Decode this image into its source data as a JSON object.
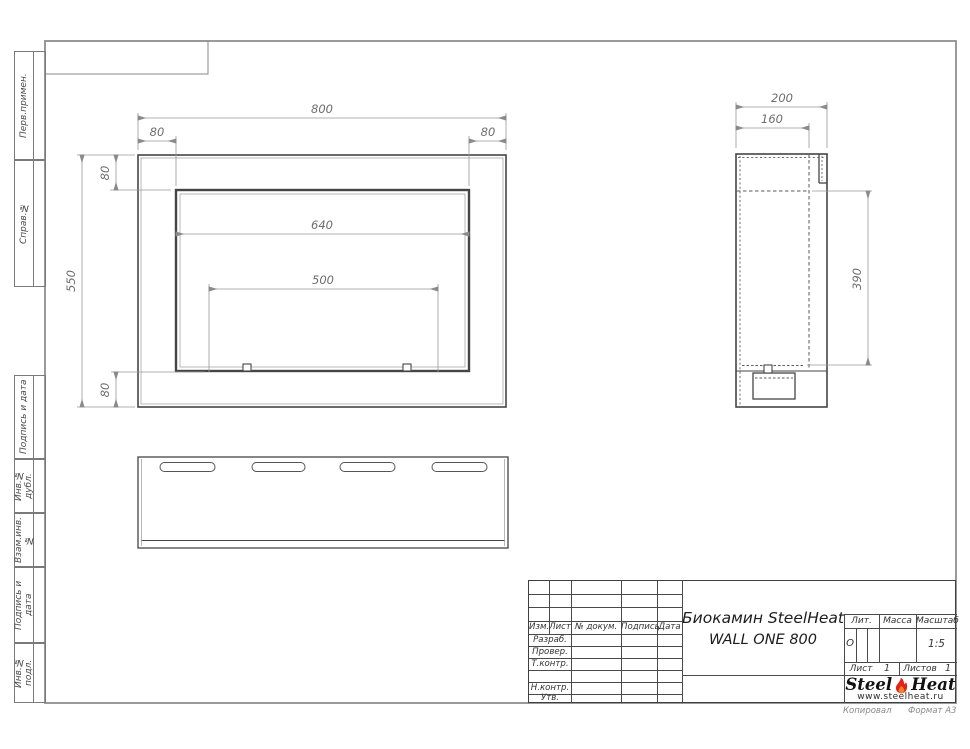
{
  "sidebar": {
    "top": [
      "Перв.примен.",
      "Справ.№"
    ],
    "bottom": [
      "Подпись и дата",
      "Инв.№ дубл.",
      "Взам.инв.№",
      "Подпись и дата",
      "Инв.№ подл."
    ]
  },
  "dims": {
    "front": {
      "total_width": "800",
      "flange_left": "80",
      "flange_right": "80",
      "flange_top": "80",
      "height": "550",
      "opening_width": "640",
      "burner_width": "500",
      "flange_bottom": "80"
    },
    "side": {
      "depth": "200",
      "inner_depth": "160",
      "inner_height": "390"
    }
  },
  "title_block": {
    "header_cols": [
      "Изм.",
      "Лист",
      "№ докум.",
      "Подпись",
      "Дата"
    ],
    "rows": [
      "Разраб.",
      "Провер.",
      "Т.контр.",
      "Н.контр.",
      "Утв."
    ],
    "title_line1": "Биокамин SteelHeat",
    "title_line2": "WALL ONE 800",
    "lit_label": "Лит.",
    "lit_value": "О",
    "massa_label": "Масса",
    "masshtab_label": "Масштаб",
    "masshtab_value": "1:5",
    "list_label": "Лист",
    "list_value": "1",
    "listov_label": "Листов",
    "listov_value": "1",
    "logo_steel": "Steel",
    "logo_heat": "Heat",
    "logo_url": "www.steelheat.ru",
    "kopiroval": "Копировал",
    "format": "Формат А3"
  },
  "colors": {
    "flame_red": "#e2231a",
    "flame_orange": "#f58220",
    "line_dark": "#454545",
    "line_dim": "#979797",
    "frame_gray": "#8f8f8f"
  }
}
